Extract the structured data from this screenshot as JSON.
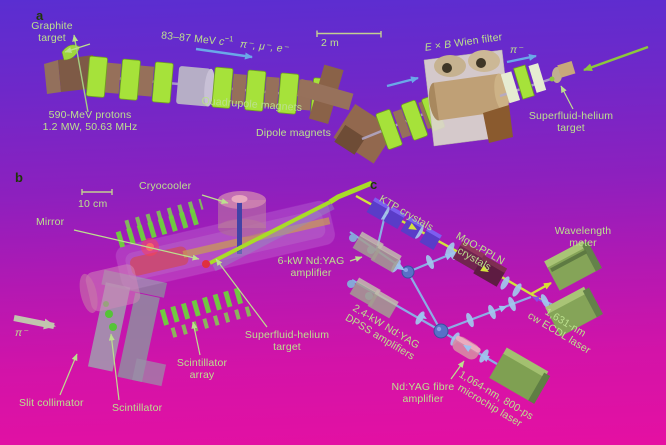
{
  "colors": {
    "bg_top": "#5a2ed1",
    "bg_bottom": "#e510a2",
    "label_green": "#bce08e",
    "panel_letter": "#1e3808",
    "beam_blue": "#8ab6e8",
    "beam_yellow": "#d4e23c",
    "laser_green": "#a8dc28",
    "magnet_green": "#a6e23a",
    "magnet_brown": "#96705a",
    "scintillator_green": "#6ed23c"
  },
  "panel_a": {
    "letter": "a",
    "graphite_target": "Graphite\ntarget",
    "momentum_prefix": "83–87 MeV ",
    "momentum_c": "c",
    "momentum_sup": "−1",
    "particles": "π⁻, μ⁻, e⁻",
    "scale": "2 m",
    "wien_e": "E",
    "wien_times": " × ",
    "wien_b": "B",
    "wien_rest": " Wien filter",
    "pion": "π⁻",
    "she_target": "Superfluid-helium\ntarget",
    "protons": "590-MeV protons\n1.2 MW, 50.63 MHz",
    "quadrupole": "Quadrupole magnets",
    "dipole": "Dipole magnets"
  },
  "panel_b": {
    "letter": "b",
    "scale": "10 cm",
    "cryocooler": "Cryocooler",
    "mirror": "Mirror",
    "amplifier": "6-kW Nd:YAG\namplifier",
    "she_target": "Superfluid-helium\ntarget",
    "scintillator_array": "Scintillator\narray",
    "slit_collimator": "Slit collimator",
    "scintillator": "Scintillator",
    "pion": "π⁻"
  },
  "panel_c": {
    "letter": "c",
    "ktp": "KTP crystals",
    "ppln": "MgO:PPLN\ncrystals",
    "wavelength_meter": "Wavelength\nmeter",
    "dpss": "2.4-kW Nd:YAG\nDPSS amplifiers",
    "ecdl": "1,631-nm\ncw ECDL laser",
    "fibre_amplifier": "Nd:YAG fibre\namplifier",
    "microchip": "1,064-nm, 800-ps\nmicrochip laser"
  }
}
